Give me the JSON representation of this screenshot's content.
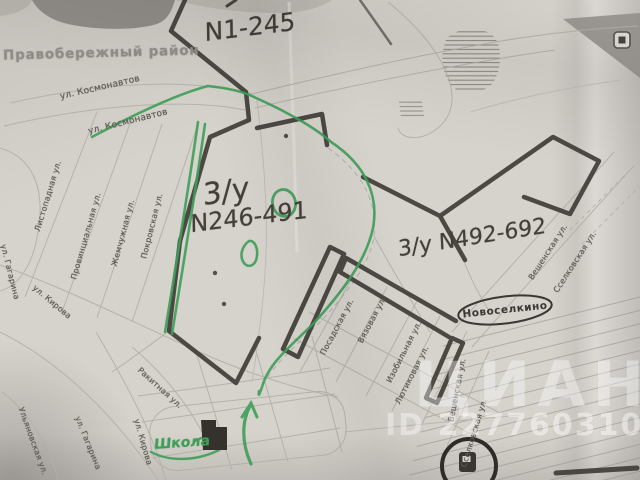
{
  "map": {
    "district_label": "Правобережный район",
    "settlement_label": "Новоселкино",
    "handwritten": {
      "plot_top": "N1-245",
      "plot_center_prefix": "3/у",
      "plot_center_range": "N246-491",
      "plot_right": "3/у N492-692",
      "school_note": "Школа"
    },
    "streets": [
      "ул. Космонавтов",
      "ул. Космонавтов",
      "Листопадная ул.",
      "Провинциальная ул.",
      "Жемчужная ул.",
      "Покровская ул.",
      "ул. Гагарина",
      "ул. Кирова",
      "Ракитная ул.",
      "ул. Гагарина",
      "ул. Кирова",
      "Ульяновская ул.",
      "Посадская ул.",
      "Вязовая ул.",
      "Изобильная ул.",
      "Лютиковая ул.",
      "Вешенская ул.",
      "Сселковская ул.",
      "Вешенская ул.",
      "Сселковская ул."
    ],
    "watermark": {
      "brand": "ЦИАН",
      "id_label": "ID 227760310"
    },
    "icons": {
      "school": "school-building-icon",
      "fuel": "fuel-station-icon",
      "landmark": "landmark-icon",
      "arrow": "direction-arrow-icon"
    },
    "colors": {
      "paper": "#d6d2cc",
      "marker_green": "#3f9f58",
      "boundary_ink": "#423e39",
      "street_text": "#5e5a55",
      "district_text": "#918d88",
      "watermark": "rgba(255,255,255,0.40)"
    }
  }
}
